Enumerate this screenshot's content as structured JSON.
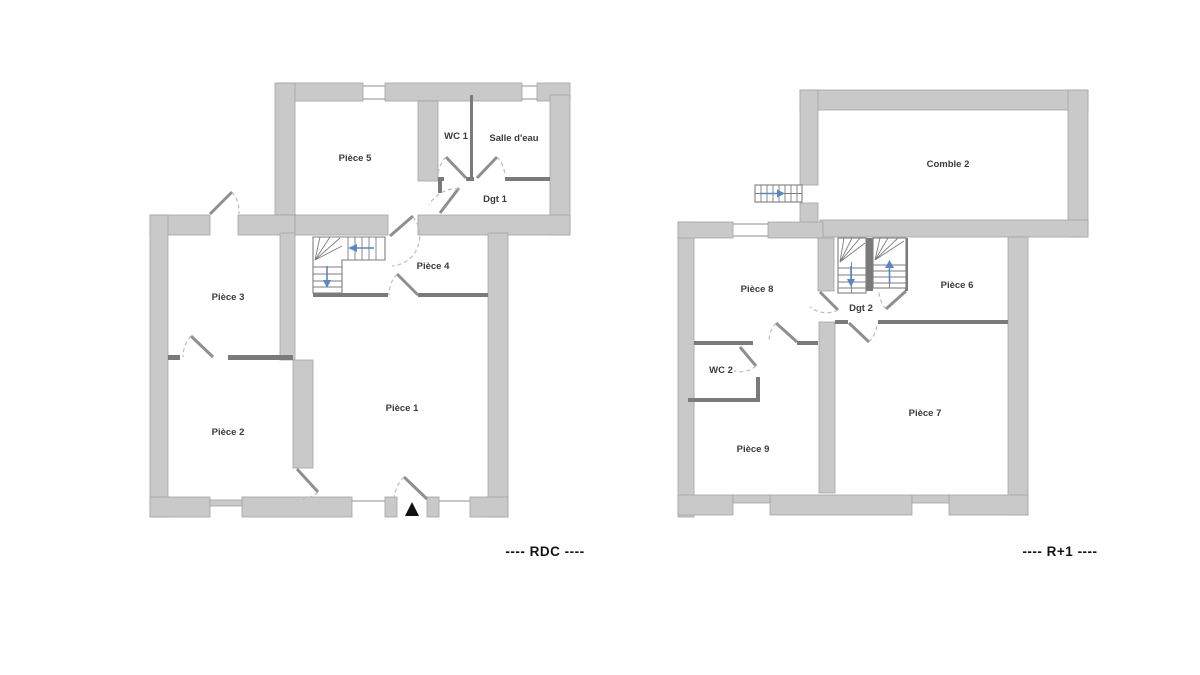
{
  "document": {
    "type": "floor-plan-drawing",
    "floors": [
      {
        "id": "rdc",
        "title": "---- RDC ----"
      },
      {
        "id": "r1",
        "title": "---- R+1 ----"
      }
    ]
  },
  "rdc": {
    "title": "---- RDC ----",
    "rooms": [
      {
        "label": "Pièce 5"
      },
      {
        "label": "WC 1"
      },
      {
        "label": "Salle d'eau"
      },
      {
        "label": "Dgt 1"
      },
      {
        "label": "Pièce 4"
      },
      {
        "label": "Pièce 3"
      },
      {
        "label": "Pièce 2"
      },
      {
        "label": "Pièce 1"
      }
    ]
  },
  "r1": {
    "title": "---- R+1 ----",
    "rooms": [
      {
        "label": "Comble 2"
      },
      {
        "label": "Pièce 8"
      },
      {
        "label": "Dgt 2"
      },
      {
        "label": "Pièce 6"
      },
      {
        "label": "WC 2"
      },
      {
        "label": "Pièce 9"
      },
      {
        "label": "Pièce 7"
      }
    ]
  },
  "icons": {
    "entrance_marker": "black triangle pointing up at main door",
    "stair_arrows": [
      "left",
      "down",
      "down",
      "up",
      "right"
    ]
  },
  "colors": {
    "background": "#ffffff",
    "wall": "#c9c9c9",
    "wall_edge": "#a3a3a3",
    "thin_wall": "#7a7a7a",
    "door_leaf": "#8f8f8f",
    "door_arc": "#bdbdbd",
    "stair": "#7d7d7d",
    "arrow": "#5b87c5",
    "room_label": "#3b3b3b",
    "floor_title": "#141414",
    "entrance_marker": "#111111"
  }
}
